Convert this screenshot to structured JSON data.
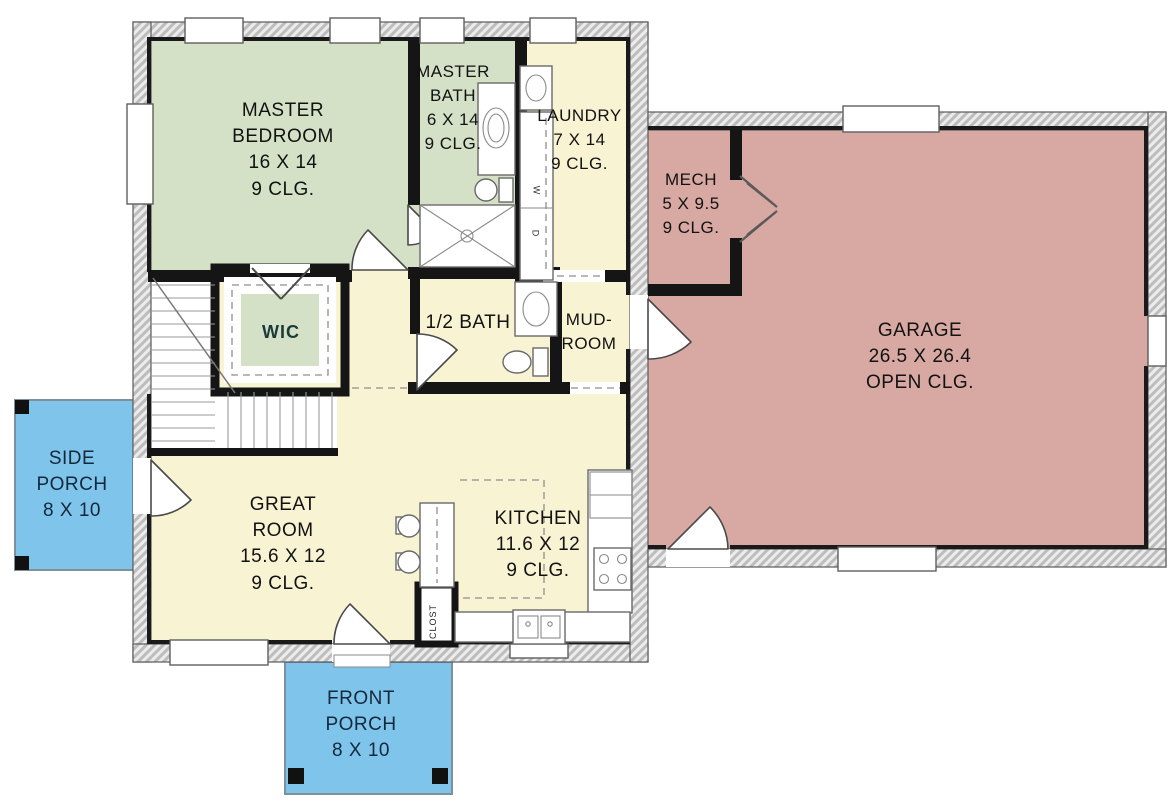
{
  "plan_title": "First floor plan",
  "colors": {
    "room_green": "#d4e1c7",
    "room_yellow": "#f8f3d3",
    "garage_pink": "#d8a8a2",
    "porch_blue": "#7fc5eb",
    "wall": "#151515"
  },
  "rooms": {
    "master_bedroom": {
      "label": "MASTER\nBEDROOM\n16 X 14\n9 CLG."
    },
    "master_bath": {
      "label": "MASTER\nBATH\n6 X 14\n9 CLG."
    },
    "laundry": {
      "label": "LAUNDRY\n7 X 14\n9 CLG."
    },
    "mech": {
      "label": "MECH\n5 X 9.5\n9 CLG."
    },
    "garage": {
      "label": "GARAGE\n26.5 X 26.4\nOPEN CLG."
    },
    "wic": {
      "label": "WIC"
    },
    "half_bath": {
      "label": "1/2 BATH"
    },
    "mud_room": {
      "label": "MUD-\nROOM"
    },
    "great_room": {
      "label": "GREAT\nROOM\n15.6 X 12\n9 CLG."
    },
    "kitchen": {
      "label": "KITCHEN\n11.6 X 12\n9 CLG."
    },
    "side_porch": {
      "label": "SIDE\nPORCH\n8 X 10"
    },
    "front_porch": {
      "label": "FRONT\nPORCH\n8 X 10"
    },
    "closet": {
      "label": "CLOST"
    },
    "washer": {
      "label": "W"
    },
    "dryer": {
      "label": "D"
    }
  }
}
